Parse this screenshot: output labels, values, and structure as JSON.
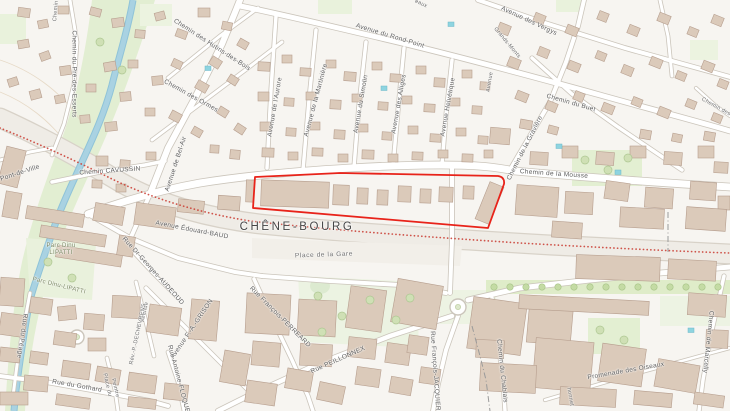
{
  "map": {
    "locality": "CHÊNE-BOURG",
    "highlight": {
      "description": "red outlined parcel along Rue de Geneve",
      "color": "#e8231a"
    },
    "colors": {
      "background": "#f7f5f1",
      "building": "#dbcaba",
      "building_outline": "#b69e8e",
      "road_fill": "#ffffff",
      "road_casing": "#cbc5bb",
      "green": "#e5efd4",
      "green_dark": "#c9dfaa",
      "water": "#a9d2e2",
      "rail_band": "#efece6",
      "boundary_red": "#cb4238",
      "label_gray": "#5f5f5f"
    },
    "labels": [
      {
        "text": "Chemin",
        "x": 56,
        "y": 11,
        "rot": -85,
        "cls": "sm"
      },
      {
        "text": "Chemin du Pré-des-Esserts",
        "x": 74,
        "y": 74,
        "rot": 90,
        "cls": "st"
      },
      {
        "text": "Chemin des Hutins-des-Bois",
        "x": 212,
        "y": 45,
        "rot": 33,
        "cls": "st"
      },
      {
        "text": "Chemin des Ormes",
        "x": 191,
        "y": 96,
        "rot": 29,
        "cls": "st"
      },
      {
        "text": "eaux",
        "x": 421,
        "y": 4,
        "rot": 25,
        "cls": "sm"
      },
      {
        "text": "Avenue du Rond-Point",
        "x": 390,
        "y": 36,
        "rot": 17,
        "cls": "st"
      },
      {
        "text": "Avenue de l'Aurore",
        "x": 275,
        "y": 107,
        "rot": -80,
        "cls": "st"
      },
      {
        "text": "Avenue de la Martinière",
        "x": 316,
        "y": 100,
        "rot": -75,
        "cls": "st"
      },
      {
        "text": "Avenue du Simolin",
        "x": 361,
        "y": 104,
        "rot": -80,
        "cls": "st"
      },
      {
        "text": "Avenue des Alliges",
        "x": 399,
        "y": 104,
        "rot": -80,
        "cls": "st"
      },
      {
        "text": "Avenue Helvétique",
        "x": 448,
        "y": 107,
        "rot": -80,
        "cls": "st"
      },
      {
        "text": "Avenue des Vergys",
        "x": 529,
        "y": 21,
        "rot": 25,
        "cls": "st"
      },
      {
        "text": "Grands-Monts",
        "x": 507,
        "y": 43,
        "rot": 50,
        "cls": "sm"
      },
      {
        "text": "Avenue",
        "x": 490,
        "y": 82,
        "rot": -80,
        "cls": "sm"
      },
      {
        "text": "Chemin du Buet",
        "x": 571,
        "y": 103,
        "rot": 16,
        "cls": "st"
      },
      {
        "text": "Chemin des",
        "x": 716,
        "y": 107,
        "rot": 29,
        "cls": "sm"
      },
      {
        "text": "Chemin de la Gravière",
        "x": 525,
        "y": 148,
        "rot": -63,
        "cls": "st"
      },
      {
        "text": "Chemin de la Mousse",
        "x": 554,
        "y": 174,
        "rot": 4,
        "cls": "st"
      },
      {
        "text": "Chemin CAVUSSIN",
        "x": 110,
        "y": 171,
        "rot": -4,
        "cls": "st"
      },
      {
        "text": "Pont-de-Ville",
        "x": 20,
        "y": 173,
        "rot": -18,
        "cls": "st"
      },
      {
        "text": "Avenue de Bel-Air",
        "x": 176,
        "y": 164,
        "rot": -72,
        "cls": "st"
      },
      {
        "text": "CHÊNE-BOURG",
        "x": 297,
        "y": 227,
        "rot": 0,
        "cls": "locality"
      },
      {
        "text": "Avenue Édouard-BAUD",
        "x": 192,
        "y": 230,
        "rot": 11,
        "cls": "st"
      },
      {
        "text": "Place de la Gare",
        "x": 324,
        "y": 255,
        "rot": -2,
        "cls": "place"
      },
      {
        "text": "Parc Dinu",
        "x": 61,
        "y": 246,
        "rot": 0,
        "cls": "park"
      },
      {
        "text": "LIPATTI",
        "x": 61,
        "y": 253,
        "rot": 0,
        "cls": "park"
      },
      {
        "text": "Parc Dinu-LIPATTI",
        "x": 59,
        "y": 286,
        "rot": 14,
        "cls": "park"
      },
      {
        "text": "Rue Dr-Georges-AUDEOUD",
        "x": 153,
        "y": 271,
        "rot": 48,
        "cls": "st"
      },
      {
        "text": "Avenue",
        "x": 145,
        "y": 312,
        "rot": -78,
        "cls": "sm"
      },
      {
        "text": "Rév.-P.-DECHEVRENS",
        "x": 138,
        "y": 334,
        "rot": -78,
        "cls": "sm"
      },
      {
        "text": "Avenue F.-A.-GRISON",
        "x": 192,
        "y": 329,
        "rot": -56,
        "cls": "st"
      },
      {
        "text": "Rue Antoine-FLOQUET",
        "x": 179,
        "y": 381,
        "rot": 75,
        "cls": "st"
      },
      {
        "text": "Rue du Péage",
        "x": 22,
        "y": 336,
        "rot": 98,
        "cls": "st"
      },
      {
        "text": "Rue du Gothard",
        "x": 77,
        "y": 386,
        "rot": 10,
        "cls": "st"
      },
      {
        "text": "Place du",
        "x": 107,
        "y": 385,
        "rot": 77,
        "cls": "sm"
      },
      {
        "text": "Peintre",
        "x": 115,
        "y": 388,
        "rot": 77,
        "cls": "sm"
      },
      {
        "text": "Rue François-PERREARD",
        "x": 280,
        "y": 317,
        "rot": 45,
        "cls": "st"
      },
      {
        "text": "Rue PEILLONNEX",
        "x": 338,
        "y": 360,
        "rot": -24,
        "cls": "st"
      },
      {
        "text": "Rue François-JACQUIER",
        "x": 435,
        "y": 371,
        "rot": 86,
        "cls": "st"
      },
      {
        "text": "Chemin du Chablais",
        "x": 502,
        "y": 371,
        "rot": 84,
        "cls": "st"
      },
      {
        "text": "Promenade des Oiseaux",
        "x": 626,
        "y": 371,
        "rot": -10,
        "cls": "st"
      },
      {
        "text": "Chemin de Marcelly",
        "x": 708,
        "y": 342,
        "rot": 96,
        "cls": "st"
      },
      {
        "text": "honnet",
        "x": 570,
        "y": 397,
        "rot": 80,
        "cls": "sm"
      }
    ]
  }
}
